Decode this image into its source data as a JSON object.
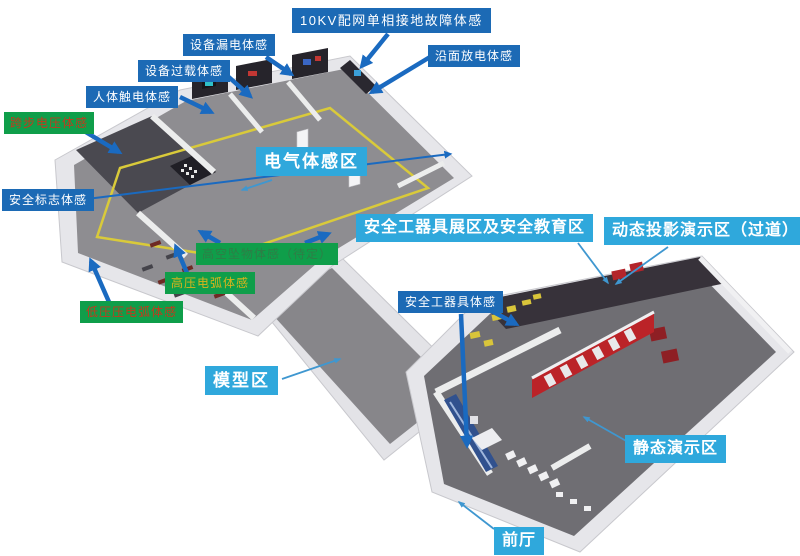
{
  "colors": {
    "label_blue": "#1c6ab5",
    "label_cyan": "#2fa8dc",
    "label_green": "#0f9e4a",
    "arrow_blue": "#1a6ac0",
    "thin_line_blue": "#3f97d0",
    "green_label_text_red": "#c23a1e",
    "green_label_text_yellow": "#d9b31c",
    "green_label_text_dark_green": "#2f7d46",
    "floor_gray": "#8e8d91",
    "floor_gray_dark": "#6f6e73",
    "wall_white": "#eceded",
    "dark_exhibit_wall": "#37323a",
    "red_display_wall": "#bb2328",
    "yellow_floor_line": "#d9ca3a"
  },
  "labels": {
    "kv10_fault": "10KV配网单相接地故障体感",
    "equipment_leakage": "设备漏电体感",
    "equipment_overload": "设备过载体感",
    "human_shock": "人体触电体感",
    "surface_discharge": "沿面放电体感",
    "step_voltage": "跨步电压体感",
    "safety_sign": "安全标志体感",
    "electrical_zone": "电气体感区",
    "falling_object": "高空坠物体感（待定）",
    "hv_arc": "高压电弧体感",
    "lv_arc": "低压压电弧体感",
    "tool_exhibit_zone": "安全工器具展区及安全教育区",
    "dynamic_projection_zone": "动态投影演示区（过道）",
    "safety_tool": "安全工器具体感",
    "model_zone": "模型区",
    "static_demo_zone": "静态演示区",
    "lobby": "前厅"
  }
}
